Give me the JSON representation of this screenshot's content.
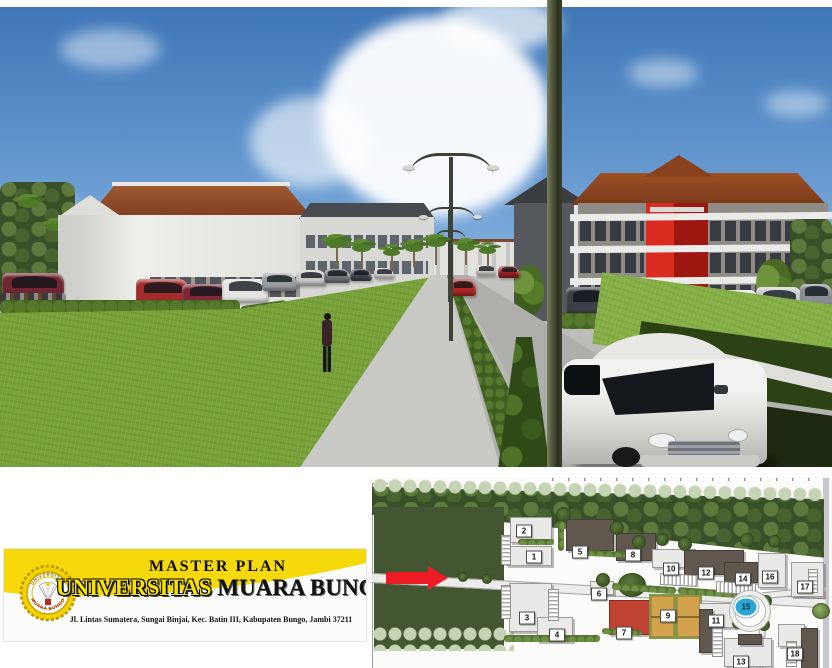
{
  "banner": {
    "title": "MASTER PLAN",
    "university_highlight": "UNIVERSITAS",
    "university_rest": " MUARA BUNGO",
    "address": "Jl. Lintas Sumatera, Sungai Binjai, Kec. Batin III, Kabupaten Bungo, Jambi 37211",
    "logo": {
      "arc_top": "UNIVERSITAS",
      "arc_bottom": "MUARA BUNGO"
    }
  },
  "siteplan": {
    "markers": [
      {
        "label": "1"
      },
      {
        "label": "2"
      },
      {
        "label": "3"
      },
      {
        "label": "4"
      },
      {
        "label": "5"
      },
      {
        "label": "6"
      },
      {
        "label": "7"
      },
      {
        "label": "8"
      },
      {
        "label": "9"
      },
      {
        "label": "10"
      },
      {
        "label": "11"
      },
      {
        "label": "12"
      },
      {
        "label": "13"
      },
      {
        "label": "14"
      },
      {
        "label": "15"
      },
      {
        "label": "16"
      },
      {
        "label": "17"
      },
      {
        "label": "18"
      }
    ]
  },
  "palette": {
    "banner_yellow": "#f6d90a",
    "highlight_text_yellow": "#f6e400",
    "arrow_red": "#ed1c24",
    "roundabout_blue": "#2aa6d5",
    "red_building_plan": "#c04232",
    "court_tan": "#d2a24c",
    "facade_red": "#d92b1f",
    "roof_terracotta": "#8a4a28",
    "field_green": "#445631"
  }
}
